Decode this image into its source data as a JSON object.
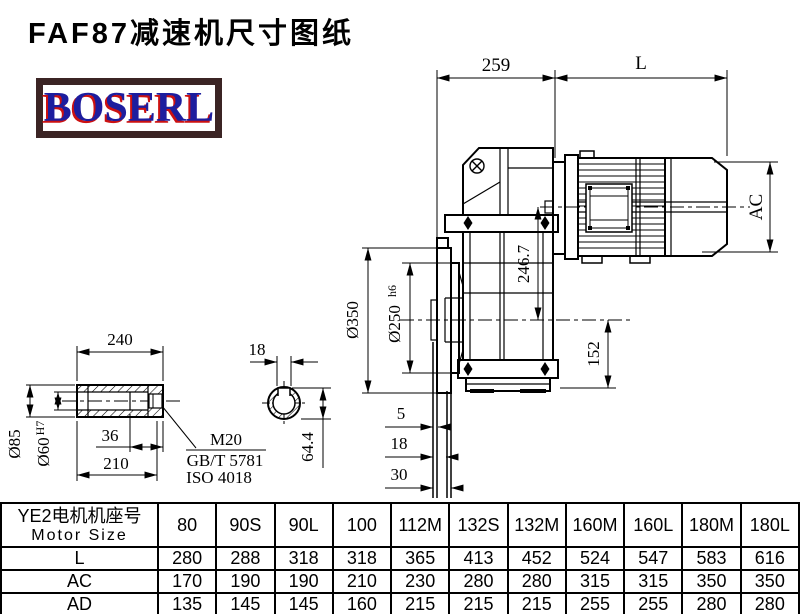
{
  "title": "FAF87减速机尺寸图纸",
  "logo": {
    "text": "BOSERL"
  },
  "colors": {
    "background": "#ffffff",
    "line": "#000000",
    "logo_border": "#3b2424",
    "logo_text": "#1d1d9e",
    "logo_shadow": "#cc1111"
  },
  "drawing": {
    "main_view": {
      "dim_259": "259",
      "dim_L": "L",
      "dim_AC": "AC",
      "dim_246_7": "246.7",
      "dim_152": "152",
      "dim_flange_od": "Ø350",
      "dim_spigot": "Ø250",
      "dim_spigot_tol": "h6",
      "dim_5": "5",
      "dim_18": "18",
      "dim_30": "30"
    },
    "shaft_view": {
      "dim_240": "240",
      "dim_hub_od": "Ø85",
      "dim_bore": "Ø60",
      "dim_bore_tol": "H7",
      "dim_36": "36",
      "dim_210": "210",
      "thread_label": "M20",
      "standard_gb": "GB/T 5781",
      "standard_iso": "ISO 4018"
    },
    "section_view": {
      "dim_keyway_width": "18",
      "dim_keyway_depth": "64.4"
    }
  },
  "table": {
    "row_header_line1": "YE2电机机座号",
    "row_header_line2": "Motor Size",
    "columns": [
      "80",
      "90S",
      "90L",
      "100",
      "112M",
      "132S",
      "132M",
      "160M",
      "160L",
      "180M",
      "180L"
    ],
    "rows": [
      {
        "label": "L",
        "values": [
          "280",
          "288",
          "318",
          "318",
          "365",
          "413",
          "452",
          "524",
          "547",
          "583",
          "616"
        ]
      },
      {
        "label": "AC",
        "values": [
          "170",
          "190",
          "190",
          "210",
          "230",
          "280",
          "280",
          "315",
          "315",
          "350",
          "350"
        ]
      },
      {
        "label": "AD",
        "values": [
          "135",
          "145",
          "145",
          "160",
          "215",
          "215",
          "215",
          "255",
          "255",
          "280",
          "280"
        ]
      }
    ]
  }
}
